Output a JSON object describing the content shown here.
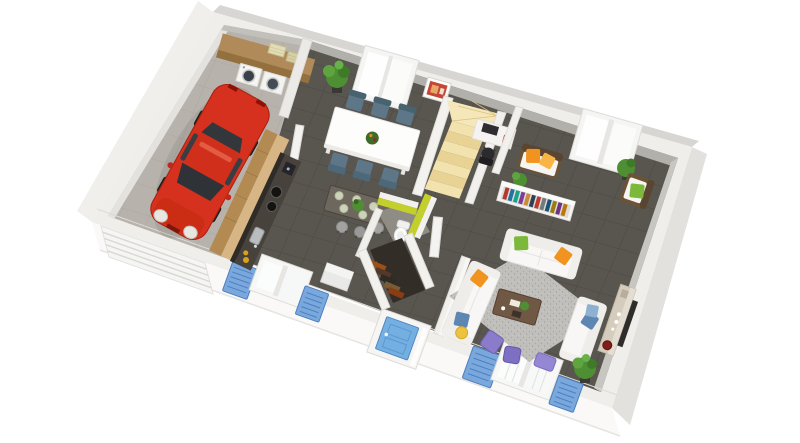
{
  "scene": {
    "type": "3D rendered ground-floor house plan, isometric top view",
    "background": "#ffffff",
    "floor_finish_main": "dark grey tiles",
    "floor_finish_garage": "light grey concrete"
  },
  "palette": {
    "page_bg": "#ffffff",
    "main_floor": "#59554f",
    "tile_line": "#4c4843",
    "garage_floor": "#b7b3ac",
    "wall_top": "#efeeeb",
    "wall_inner_shadow": "#b2b0ab",
    "wall_outer": "#d8d6d2",
    "plinth_white": "#faf9f8",
    "accent_lime": "#c3d02c",
    "shutter_blue": "#7aa8dd",
    "door_blue": "#74afe2",
    "window_frame": "#f6f6f5",
    "car_red": "#d5311e",
    "car_glass": "#2f3338",
    "wood_light": "#d7b584",
    "wood_mid": "#b08a58",
    "counter_dark": "#48423c",
    "stair_cream": "#f2e2ae",
    "stair_shade": "#e9d394",
    "sofa_white": "#f8f7f5",
    "rattan_brown": "#6b5336",
    "chair_blue": "#5d7789",
    "pillow_green": "#7cb83a",
    "pillow_orange": "#f0941f",
    "pillow_blue": "#5d87b2",
    "pillow_yellow": "#ecc23f",
    "pillow_purple": "#8a7bcb",
    "rug_grey": "#c0bfbc",
    "plant_green": "#4e8f33",
    "book_red": "#b03a2e",
    "book_blue": "#2471a3",
    "book_teal": "#17a589",
    "book_purple": "#7d3c98",
    "book_tan": "#ca8a3a",
    "book_navy": "#2e4053"
  },
  "rooms": {
    "garage": {
      "label": "Garage",
      "items": [
        "red car",
        "sectional garage door",
        "wood laundry worktop",
        "washing machine",
        "tumble dryer",
        "two laundry baskets"
      ]
    },
    "kitchen": {
      "label": "Kitchen",
      "items": [
        "tall wood cabinet",
        "dark worktop with cooktop",
        "coffee machine",
        "sink",
        "bar table with plates and plant",
        "three stools",
        "window with blue shutters",
        "white low cabinet"
      ]
    },
    "dining": {
      "label": "Dining area",
      "items": [
        "white dining table",
        "six blue-grey chairs",
        "fruit bowl",
        "corner plant",
        "sliding window",
        "red wall picture"
      ]
    },
    "stairs": {
      "label": "Staircase",
      "items": [
        "cream quarter-turn stair",
        "white stringer walls"
      ]
    },
    "office_nook": {
      "label": "Desk nook",
      "items": [
        "white desk",
        "monitor",
        "black office chair",
        "red box"
      ]
    },
    "reading_corner": {
      "label": "Reading corner",
      "items": [
        "rattan bench with two orange cushions",
        "white bookshelf with colourful books",
        "rattan armchair with green cushion",
        "plants",
        "sliding window"
      ]
    },
    "living": {
      "label": "Living room",
      "items": [
        "three white sofas",
        "speckled grey rug",
        "wood coffee table",
        "three purple floor cushions",
        "sideboard with red kettle",
        "TV panel",
        "plants",
        "french window with blue shutters"
      ]
    },
    "wc": {
      "label": "WC",
      "items": [
        "lime green walls",
        "white toilet",
        "open white door"
      ]
    },
    "closet": {
      "label": "Walk-in closet",
      "items": [
        "clothes rail",
        "hanging clothes"
      ]
    },
    "hall": {
      "label": "Entrance hall",
      "items": [
        "blue front door"
      ]
    }
  },
  "counts": {
    "sofas": 3,
    "dining_chairs": 6,
    "bar_stools": 3,
    "blue_shutters": 4,
    "windows": 4,
    "floor_cushions": 3,
    "plants": 5
  }
}
